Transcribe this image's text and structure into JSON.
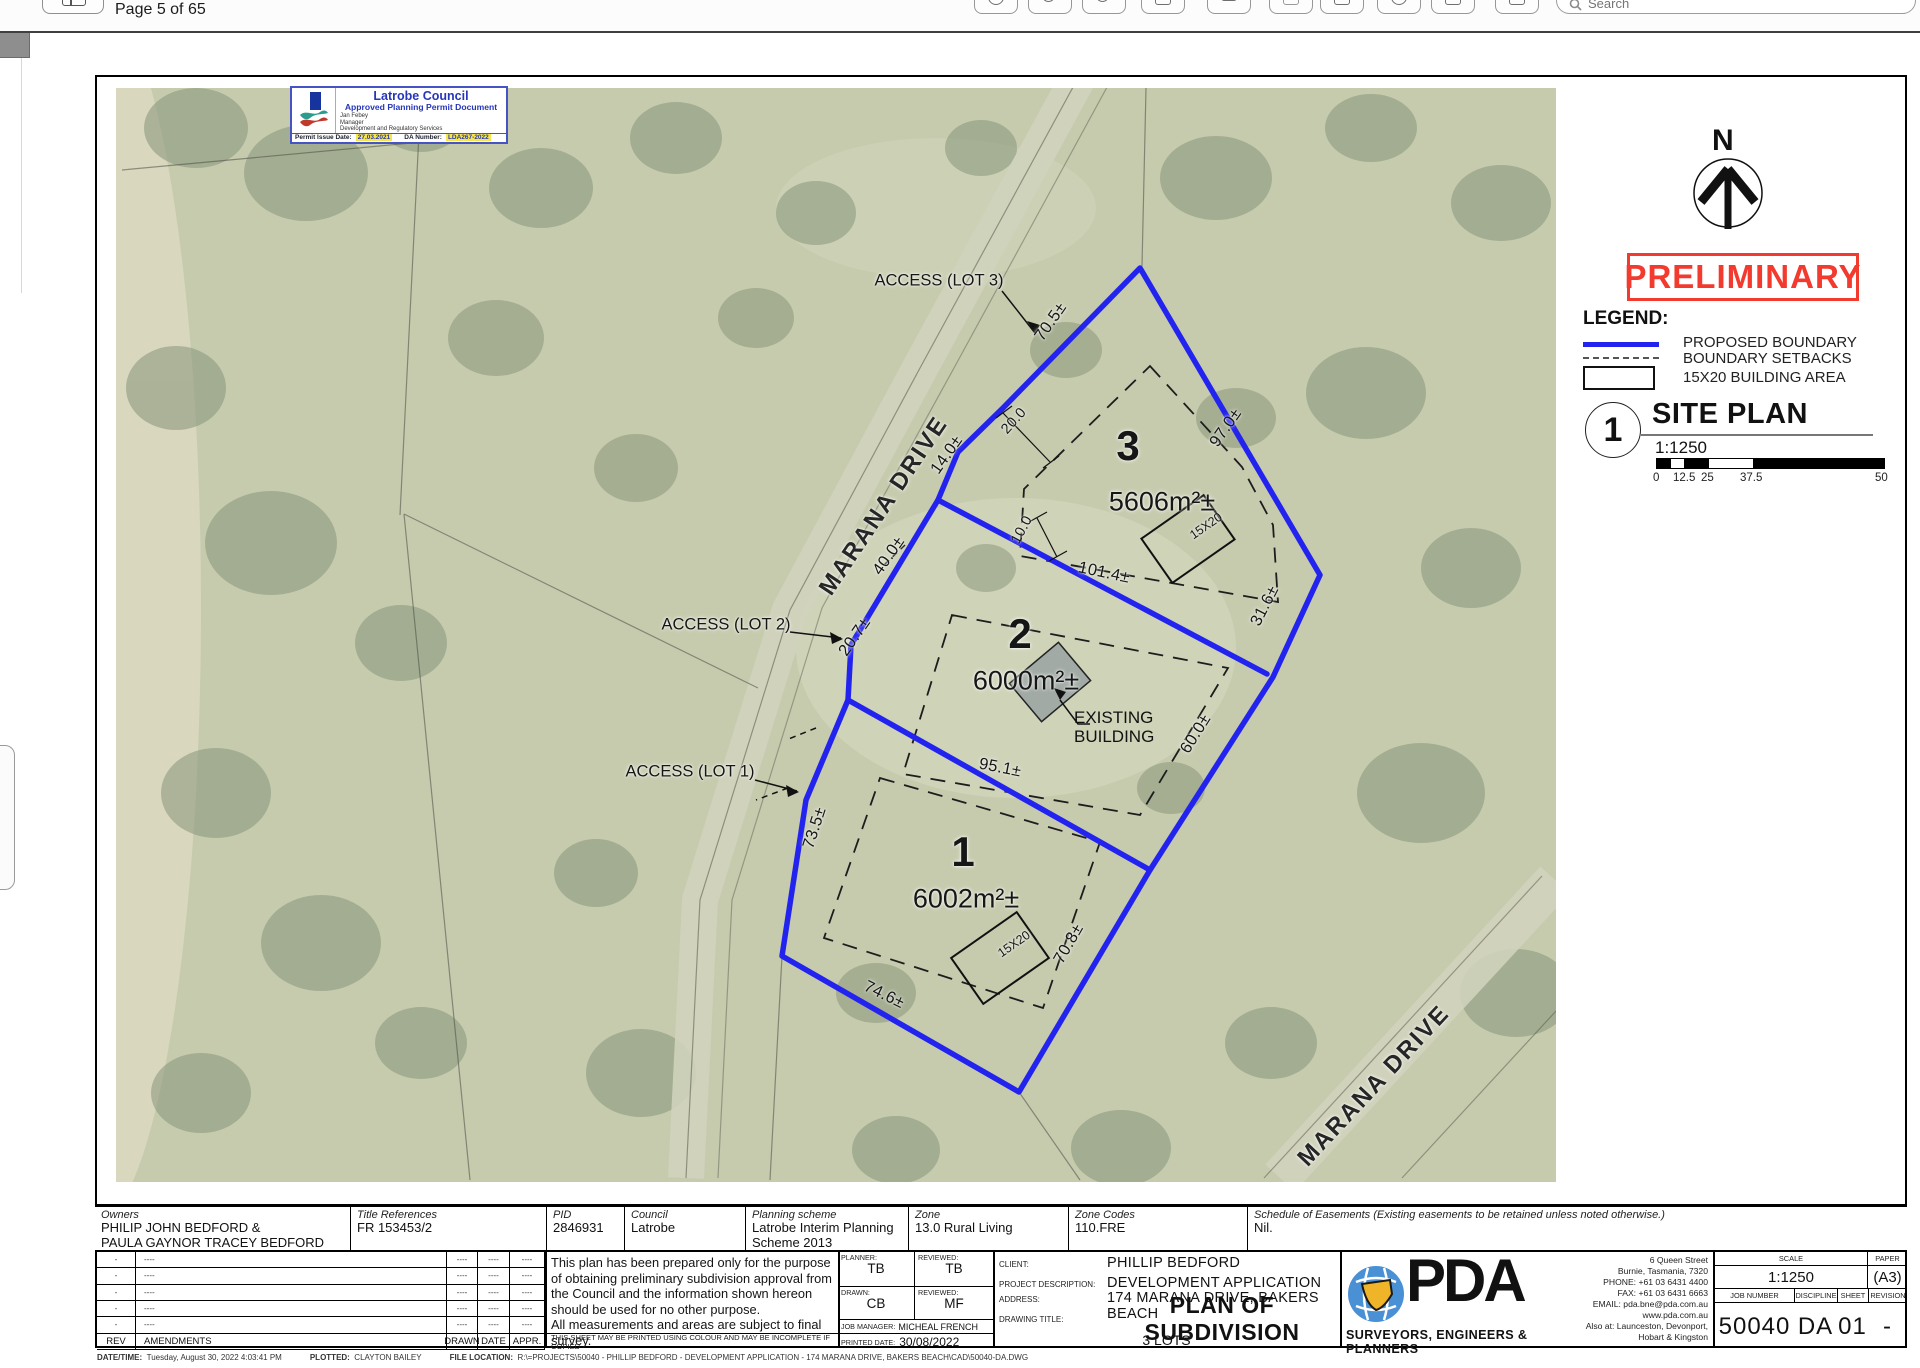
{
  "window": {
    "page_indicator": "Page 5 of 65",
    "search_placeholder": "Search"
  },
  "stamp": {
    "council": "Latrobe Council",
    "subtitle": "Approved Planning Permit Document",
    "officer": "Jan Febey",
    "officer_role": "Manager",
    "officer_dept": "Development and Regulatory Services",
    "issue_label": "Permit Issue Date:",
    "issue_date": "27.03.2021",
    "da_label": "DA Number:",
    "da_number": "LDA267-2022"
  },
  "compass": {
    "north": "N"
  },
  "watermark": "PRELIMINARY",
  "legend": {
    "title": "LEGEND:",
    "proposed_boundary": "PROPOSED BOUNDARY",
    "boundary_setbacks": "BOUNDARY SETBACKS",
    "building_area": "15X20 BUILDING AREA"
  },
  "site_plan": {
    "number": "1",
    "title": "SITE PLAN",
    "scale": "1:1250",
    "ticks": [
      "0",
      "12.5",
      "25",
      "37.5",
      "50"
    ]
  },
  "map": {
    "road_nw": "MARANA DRIVE",
    "road_se": "MARANA DRIVE",
    "access": {
      "lot3": "ACCESS (LOT 3)",
      "lot2": "ACCESS (LOT 2)",
      "lot1": "ACCESS (LOT 1)"
    },
    "lots": {
      "lot3": {
        "number": "3",
        "area": "5606m²±",
        "building": "15X20"
      },
      "lot2": {
        "number": "2",
        "area": "6000m²±"
      },
      "lot1": {
        "number": "1",
        "area": "6002m²±",
        "building": "15X20"
      }
    },
    "existing_building_line1": "EXISTING",
    "existing_building_line2": "BUILDING",
    "dims": {
      "d70_5": "70.5±",
      "d97_0": "97.0±",
      "d20_0": "20.0",
      "d14_0": "14.0±",
      "d40_0": "40.0±",
      "d10_0": "10.0",
      "d101_4": "101.4±",
      "d31_6": "31.6±",
      "d20_7": "20.7±",
      "d60_0": "60.0±",
      "d95_1": "95.1±",
      "d73_5": "73.5±",
      "d70_8": "70.8±",
      "d74_6": "74.6±"
    }
  },
  "info_table": {
    "owners_label": "Owners",
    "owners_line1": "PHILIP JOHN BEDFORD &",
    "owners_line2": "PAULA GAYNOR TRACEY BEDFORD",
    "title_refs_label": "Title References",
    "title_refs": "FR 153453/2",
    "pid_label": "PID",
    "pid": "2846931",
    "council_label": "Council",
    "council": "Latrobe",
    "planning_label": "Planning scheme",
    "planning_line1": "Latrobe Interim Planning",
    "planning_line2": "Scheme 2013",
    "zone_label": "Zone",
    "zone": "13.0 Rural Living",
    "zone_codes_label": "Zone Codes",
    "zone_codes": "110.FRE",
    "easements_label": "Schedule of Easements (Existing easements to be retained unless noted otherwise.)",
    "easements": "Nil."
  },
  "title_block": {
    "rev_rows": [
      {
        "rev": "-",
        "amend": "----",
        "drawn": "----",
        "date": "----",
        "appr": "----"
      },
      {
        "rev": "-",
        "amend": "----",
        "drawn": "----",
        "date": "----",
        "appr": "----"
      },
      {
        "rev": "-",
        "amend": "----",
        "drawn": "----",
        "date": "----",
        "appr": "----"
      },
      {
        "rev": "-",
        "amend": "----",
        "drawn": "----",
        "date": "----",
        "appr": "----"
      },
      {
        "rev": "-",
        "amend": "----",
        "drawn": "----",
        "date": "----",
        "appr": "----"
      }
    ],
    "rev_header": {
      "rev": "REV",
      "amend": "AMENDMENTS",
      "drawn": "DRAWN",
      "date": "DATE",
      "appr": "APPR."
    },
    "disclaimer1": "This plan has been prepared only for the purpose of obtaining preliminary subdivision approval from the Council and the information shown hereon should be used for no other purpose.",
    "disclaimer2": "All measurements and areas are subject to final survey.",
    "print_note": "THIS SHEET MAY BE PRINTED USING COLOUR AND MAY BE INCOMPLETE IF COPIED",
    "planner_label": "PLANNER:",
    "planner": "TB",
    "reviewed1_label": "REVIEWED:",
    "reviewed1": "TB",
    "drawn_label": "DRAWN:",
    "drawn": "CB",
    "reviewed2_label": "REVIEWED:",
    "reviewed2": "MF",
    "job_manager_label": "JOB MANAGER:",
    "job_manager": "MICHEAL FRENCH",
    "printed_label": "PRINTED DATE:",
    "printed": "30/08/2022",
    "client_label": "CLIENT:",
    "client": "PHILLIP BEDFORD",
    "project_label": "PROJECT DESCRIPTION:",
    "project": "DEVELOPMENT APPLICATION",
    "address_label": "ADDRESS:",
    "address": "174 MARANA DRIVE, BAKERS BEACH",
    "drawing_title_label": "DRAWING TITLE:",
    "drawing_title": "PLAN OF SUBDIVISION",
    "drawing_subtitle": "3 LOTS",
    "pda": {
      "name": "PDA",
      "tagline": "SURVEYORS, ENGINEERS & PLANNERS",
      "contact": [
        "6 Queen Street",
        "Burnie, Tasmania, 7320",
        "PHONE: +61 03 6431 4400",
        "FAX: +61 03 6431 6663",
        "EMAIL: pda.bne@pda.com.au",
        "www.pda.com.au",
        "Also at: Launceston, Devonport,",
        "Hobart & Kingston"
      ]
    },
    "scale_label": "SCALE",
    "scale": "1:1250",
    "paper_label": "PAPER",
    "paper": "(A3)",
    "job_label": "JOB NUMBER",
    "job": "50040",
    "discipline_label": "DISCIPLINE",
    "discipline": "DA",
    "sheet_label": "SHEET",
    "sheet": "01",
    "revision_label": "REVISION",
    "revision": "-"
  },
  "status_bar": {
    "datetime_label": "DATE/TIME:",
    "datetime": "Tuesday, August 30, 2022 4:03:41 PM",
    "plotted_label": "PLOTTED:",
    "plotted": "CLAYTON BAILEY",
    "file_label": "FILE LOCATION:",
    "file": "R:\\=PROJECTS\\50040 - PHILLIP BEDFORD - DEVELOPMENT APPLICATION - 174 MARANA DRIVE, BAKERS BEACH\\CAD\\50040-DA.DWG"
  }
}
